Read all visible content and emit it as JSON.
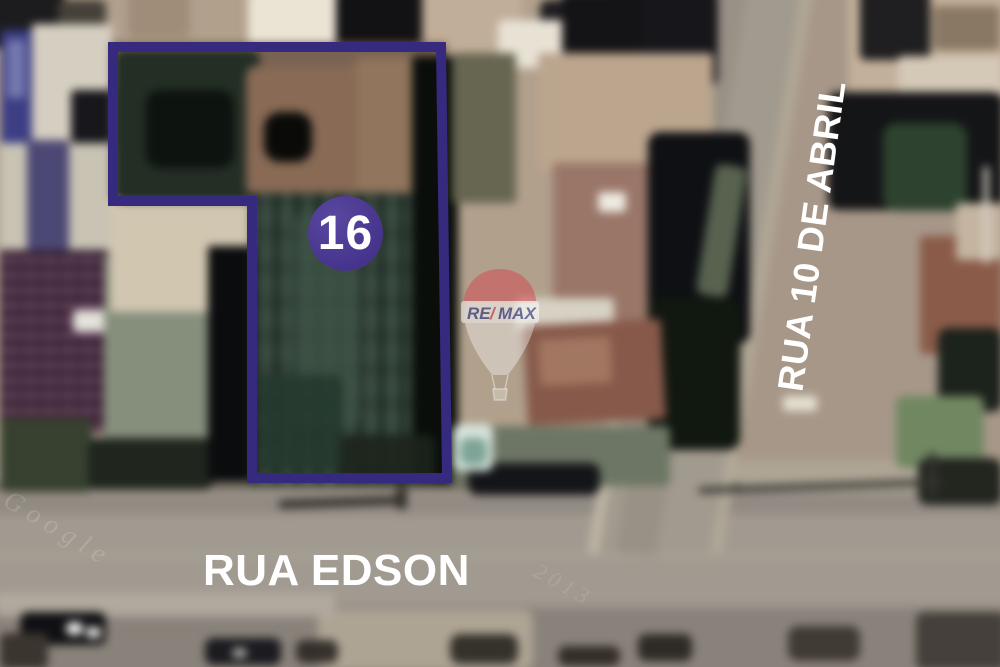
{
  "lot": {
    "number": "16",
    "outline_color": "#352a7e",
    "badge_color": "#46348c",
    "badge_text_color": "#ffffff"
  },
  "streets": {
    "horizontal": "RUA EDSON",
    "diagonal": "RUA 10 DE ABRIL",
    "label_color": "#ffffff"
  },
  "balloon": {
    "re": "RE",
    "slash": "/",
    "max": "MAX"
  },
  "ghost_watermarks": {
    "primary": "Google",
    "secondary": "2013"
  }
}
